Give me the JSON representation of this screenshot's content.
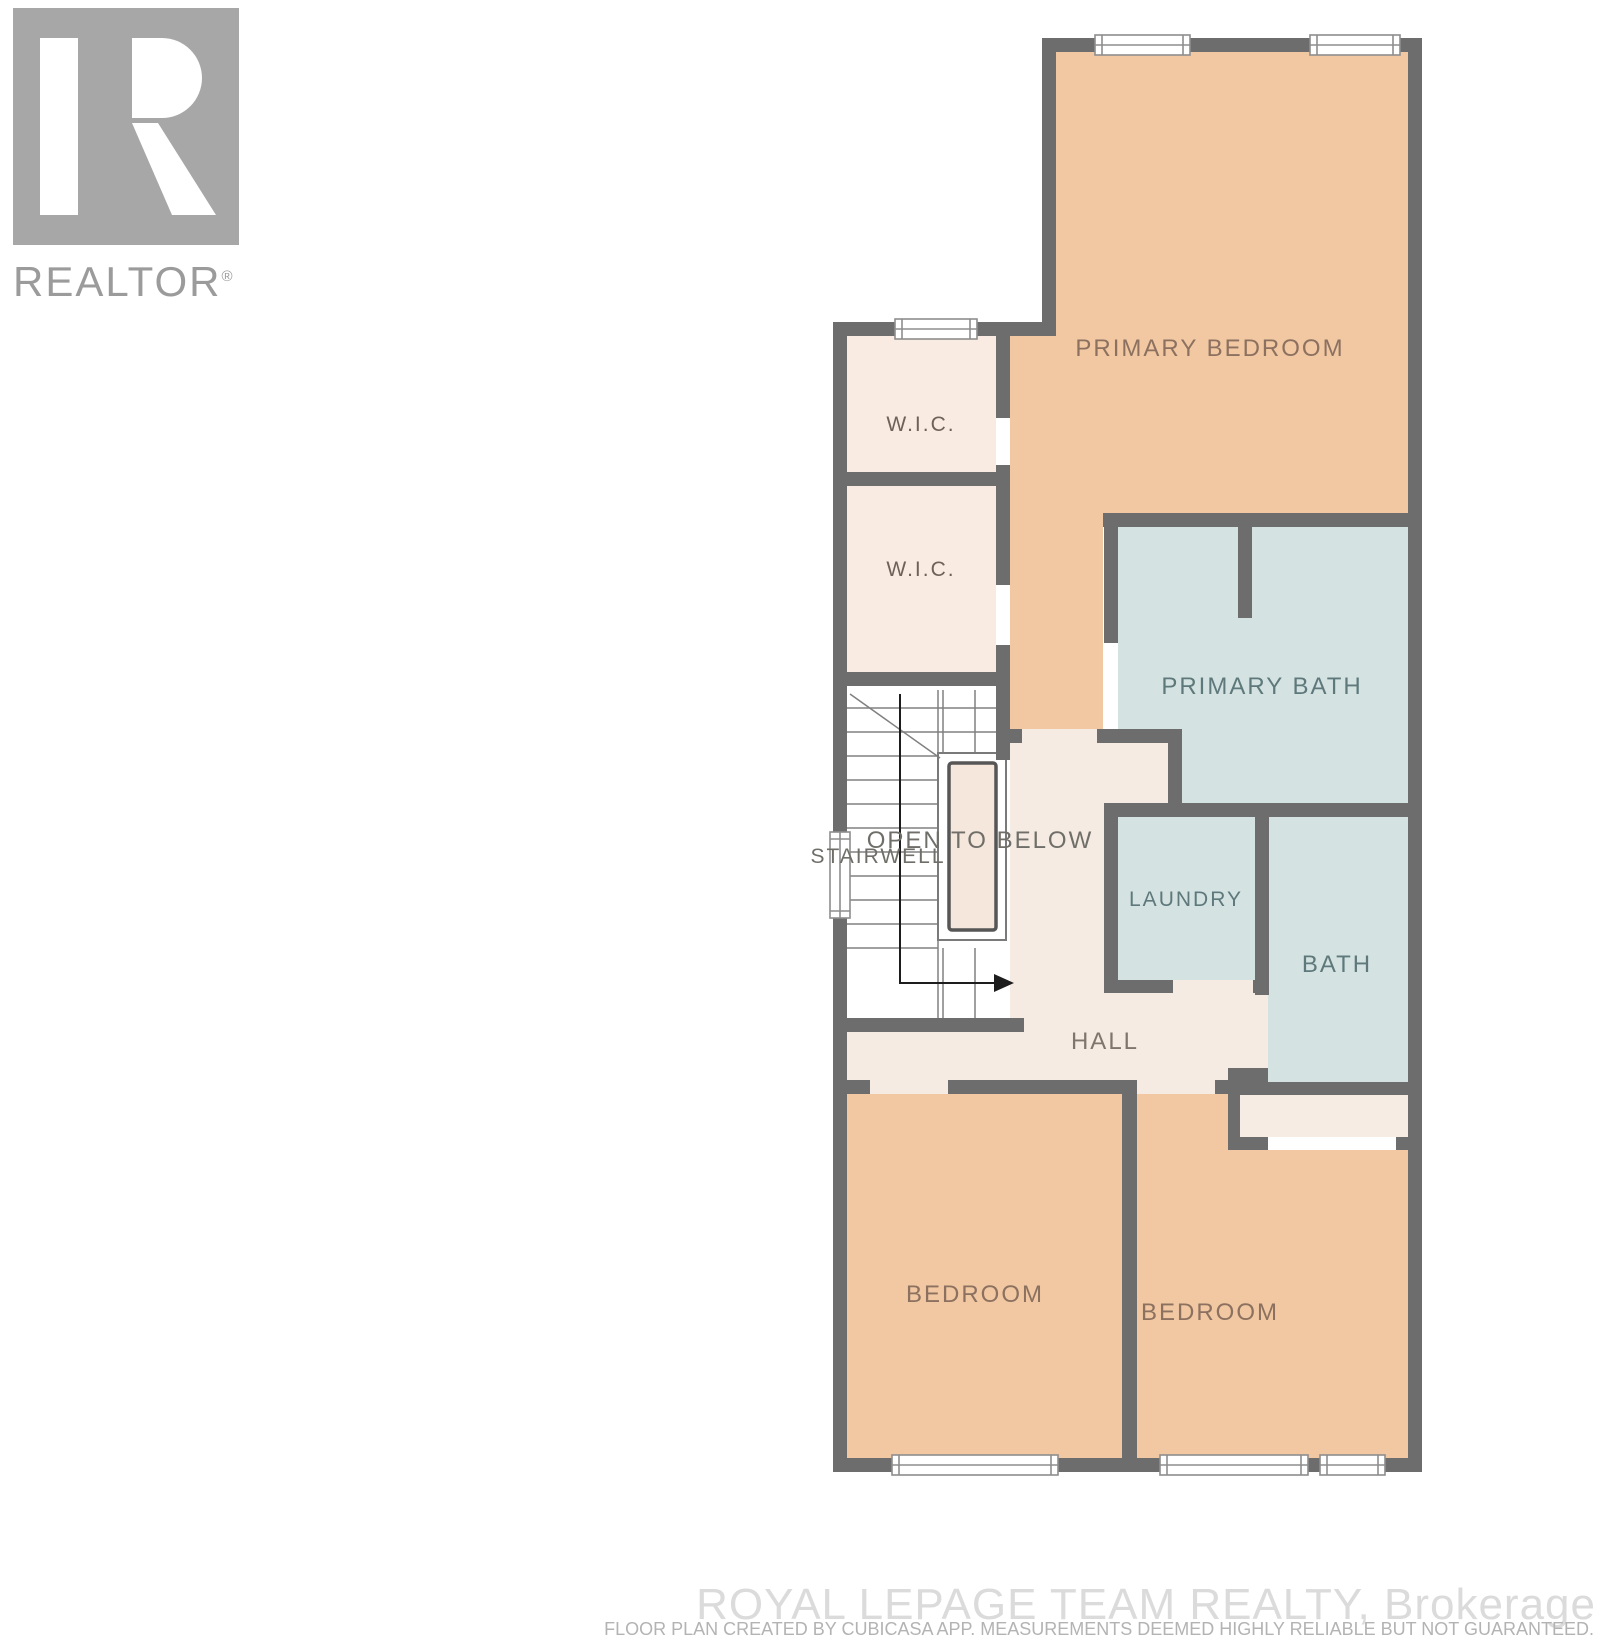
{
  "branding": {
    "realtor_logo_text": "REALTOR",
    "registered_mark": "®"
  },
  "watermark": {
    "brokerage": "ROYAL LEPAGE TEAM REALTY, Brokerage",
    "disclaimer": "FLOOR PLAN CREATED BY CUBICASA APP. MEASUREMENTS DEEMED HIGHLY RELIABLE BUT NOT GUARANTEED."
  },
  "palette": {
    "wall": "#6d6d6d",
    "bedroom": "#f1c8a2",
    "wic": "#f9ebe1",
    "hall": "#f5ebe3",
    "wet": "#d4e3e1",
    "opening": "#f5e7dc",
    "closet": "#f7ece4",
    "white": "#ffffff",
    "window_stroke": "#8e8e8e",
    "stair_line": "#808080",
    "arrow": "#1d1d1d",
    "label_warm": "#8c7160",
    "label_wic": "#6d6159",
    "label_cool": "#5e787b",
    "label_neutral": "#6f6e68",
    "label_hall": "#7f756c",
    "logo_gray": "#a7a7a7",
    "logo_text_gray": "#9b9b9b",
    "watermark_gray": "#dbdbdb",
    "disclaimer_gray": "#b3b3b3"
  },
  "rooms": [
    {
      "id": "primary-bedroom",
      "label": "PRIMARY BEDROOM",
      "cx": 1210,
      "cy": 349,
      "size": 24,
      "color": "label_warm"
    },
    {
      "id": "wic-1",
      "label": "W.I.C.",
      "cx": 921,
      "cy": 425,
      "size": 21,
      "color": "label_wic"
    },
    {
      "id": "wic-2",
      "label": "W.I.C.",
      "cx": 921,
      "cy": 570,
      "size": 21,
      "color": "label_wic"
    },
    {
      "id": "primary-bath",
      "label": "PRIMARY BATH",
      "cx": 1262,
      "cy": 687,
      "size": 24,
      "color": "label_cool"
    },
    {
      "id": "stairwell",
      "label": "STAIRWELL",
      "cx": 878,
      "cy": 857,
      "size": 21,
      "color": "label_neutral"
    },
    {
      "id": "open-to-below",
      "label": "OPEN TO BELOW",
      "cx": 980,
      "cy": 841,
      "size": 24,
      "color": "label_neutral"
    },
    {
      "id": "laundry",
      "label": "LAUNDRY",
      "cx": 1186,
      "cy": 900,
      "size": 21,
      "color": "label_cool"
    },
    {
      "id": "bath",
      "label": "BATH",
      "cx": 1337,
      "cy": 965,
      "size": 24,
      "color": "label_cool"
    },
    {
      "id": "hall",
      "label": "HALL",
      "cx": 1105,
      "cy": 1042,
      "size": 24,
      "color": "label_hall"
    },
    {
      "id": "bedroom-left",
      "label": "BEDROOM",
      "cx": 975,
      "cy": 1295,
      "size": 24,
      "color": "label_warm"
    },
    {
      "id": "bedroom-right",
      "label": "BEDROOM",
      "cx": 1210,
      "cy": 1313,
      "size": 24,
      "color": "label_warm"
    }
  ],
  "geometry": {
    "fills": [
      {
        "name": "primary-bedroom-fill",
        "color": "bedroom",
        "points": [
          [
            1056,
            52
          ],
          [
            1408,
            52
          ],
          [
            1408,
            513
          ],
          [
            1103,
            513
          ],
          [
            1103,
            729
          ],
          [
            1010,
            729
          ],
          [
            1010,
            334
          ],
          [
            1056,
            334
          ]
        ]
      },
      {
        "name": "wic-1-fill",
        "color": "wic",
        "rect": [
          847,
          336,
          149,
          136
        ]
      },
      {
        "name": "wic-2-fill",
        "color": "wic",
        "rect": [
          847,
          486,
          149,
          186
        ]
      },
      {
        "name": "stairwell-fill",
        "color": "white",
        "rect": [
          847,
          686,
          149,
          332
        ]
      },
      {
        "name": "primary-bath-fill",
        "color": "wet",
        "points": [
          [
            1118,
            527
          ],
          [
            1408,
            527
          ],
          [
            1408,
            803
          ],
          [
            1182,
            803
          ],
          [
            1182,
            743
          ],
          [
            1118,
            743
          ]
        ]
      },
      {
        "name": "laundry-fill",
        "color": "wet",
        "rect": [
          1118,
          817,
          137,
          163
        ]
      },
      {
        "name": "bath-fill",
        "color": "wet",
        "rect": [
          1268,
          817,
          140,
          265
        ]
      },
      {
        "name": "hall-fill",
        "color": "hall",
        "rect": [
          1010,
          743,
          158,
          60
        ]
      },
      {
        "name": "hall-fill",
        "color": "hall",
        "rect": [
          1010,
          803,
          94,
          277
        ]
      },
      {
        "name": "hall-fill",
        "color": "hall",
        "rect": [
          1010,
          993,
          245,
          87
        ]
      },
      {
        "name": "hall-fill",
        "color": "hall",
        "rect": [
          847,
          1032,
          177,
          48
        ]
      },
      {
        "name": "hall-fill",
        "color": "hall",
        "rect": [
          1255,
          995,
          13,
          73
        ]
      },
      {
        "name": "primary-bedroom-door-gap",
        "color": "hall",
        "rect": [
          1022,
          729,
          75,
          14
        ]
      },
      {
        "name": "laundry-door-gap",
        "color": "hall",
        "rect": [
          1173,
          980,
          80,
          13
        ]
      },
      {
        "name": "bedroom-left-door-gap",
        "color": "hall",
        "rect": [
          870,
          1080,
          78,
          14
        ]
      },
      {
        "name": "bedroom-right-door-gap",
        "color": "hall",
        "rect": [
          1137,
          1080,
          78,
          14
        ]
      },
      {
        "name": "bedroom-left-fill",
        "color": "bedroom",
        "rect": [
          847,
          1094,
          275,
          364
        ]
      },
      {
        "name": "bedroom-right-fill",
        "color": "bedroom",
        "rect": [
          1137,
          1094,
          271,
          364
        ]
      },
      {
        "name": "closet-fill",
        "color": "closet",
        "rect": [
          1240,
          1095,
          168,
          42
        ]
      },
      {
        "name": "closet-opening-gap",
        "color": "white",
        "rect": [
          1268,
          1137,
          128,
          13
        ]
      }
    ],
    "walls": [
      [
        1042,
        38,
        380,
        14
      ],
      [
        1408,
        38,
        14,
        1434
      ],
      [
        833,
        1458,
        589,
        14
      ],
      [
        833,
        322,
        14,
        1150
      ],
      [
        1042,
        38,
        14,
        298
      ],
      [
        833,
        322,
        223,
        14
      ],
      [
        833,
        472,
        177,
        14
      ],
      [
        833,
        672,
        177,
        14
      ],
      [
        996,
        334,
        14,
        84
      ],
      [
        996,
        465,
        14,
        120
      ],
      [
        996,
        645,
        14,
        41
      ],
      [
        996,
        686,
        14,
        74
      ],
      [
        833,
        1018,
        191,
        14
      ],
      [
        996,
        729,
        26,
        14
      ],
      [
        1097,
        729,
        85,
        14
      ],
      [
        1103,
        513,
        305,
        14
      ],
      [
        1104,
        527,
        14,
        116
      ],
      [
        1168,
        743,
        14,
        60
      ],
      [
        1238,
        527,
        14,
        91
      ],
      [
        1104,
        803,
        304,
        14
      ],
      [
        1104,
        817,
        14,
        176
      ],
      [
        1255,
        817,
        14,
        178
      ],
      [
        1104,
        980,
        69,
        13
      ],
      [
        1253,
        980,
        15,
        13
      ],
      [
        1255,
        1068,
        13,
        27
      ],
      [
        1228,
        1068,
        40,
        14
      ],
      [
        1228,
        1082,
        12,
        68
      ],
      [
        833,
        1080,
        37,
        14
      ],
      [
        948,
        1080,
        189,
        14
      ],
      [
        1215,
        1080,
        25,
        14
      ],
      [
        1240,
        1082,
        168,
        13
      ],
      [
        1122,
        1094,
        15,
        364
      ],
      [
        1240,
        1137,
        28,
        13
      ],
      [
        1396,
        1137,
        12,
        13
      ]
    ],
    "windows": [
      {
        "x": 1095,
        "y": 38,
        "w": 95,
        "h": 14,
        "o": "h"
      },
      {
        "x": 1310,
        "y": 38,
        "w": 90,
        "h": 14,
        "o": "h"
      },
      {
        "x": 895,
        "y": 322,
        "w": 82,
        "h": 14,
        "o": "h"
      },
      {
        "x": 833,
        "y": 832,
        "w": 14,
        "h": 86,
        "o": "v"
      },
      {
        "x": 892,
        "y": 1458,
        "w": 166,
        "h": 14,
        "o": "h"
      },
      {
        "x": 1160,
        "y": 1458,
        "w": 148,
        "h": 14,
        "o": "h"
      },
      {
        "x": 1320,
        "y": 1458,
        "w": 65,
        "h": 14,
        "o": "h"
      }
    ],
    "stairs": {
      "treads": [
        [
          847,
          708,
          1006,
          708
        ],
        [
          847,
          732,
          1006,
          732
        ],
        [
          847,
          756,
          938,
          756
        ],
        [
          847,
          780,
          938,
          780
        ],
        [
          847,
          804,
          938,
          804
        ],
        [
          847,
          828,
          938,
          828
        ],
        [
          847,
          852,
          938,
          852
        ],
        [
          847,
          876,
          938,
          876
        ],
        [
          847,
          900,
          938,
          900
        ],
        [
          847,
          924,
          938,
          924
        ],
        [
          847,
          948,
          938,
          948
        ],
        [
          938,
          690,
          938,
          1018
        ],
        [
          943,
          948,
          943,
          1018
        ],
        [
          975,
          948,
          975,
          1018
        ],
        [
          943,
          690,
          943,
          753
        ],
        [
          975,
          690,
          975,
          753
        ],
        [
          850,
          694,
          940,
          758
        ]
      ],
      "outer_rect": [
        938,
        753,
        68,
        187
      ],
      "inner_rect": [
        949,
        763,
        47,
        167
      ],
      "arrow_line": [
        [
          900,
          694
        ],
        [
          900,
          983
        ],
        [
          1006,
          983
        ]
      ],
      "arrow_head": [
        [
          1014,
          983
        ],
        [
          994,
          974
        ],
        [
          994,
          992
        ]
      ]
    }
  }
}
